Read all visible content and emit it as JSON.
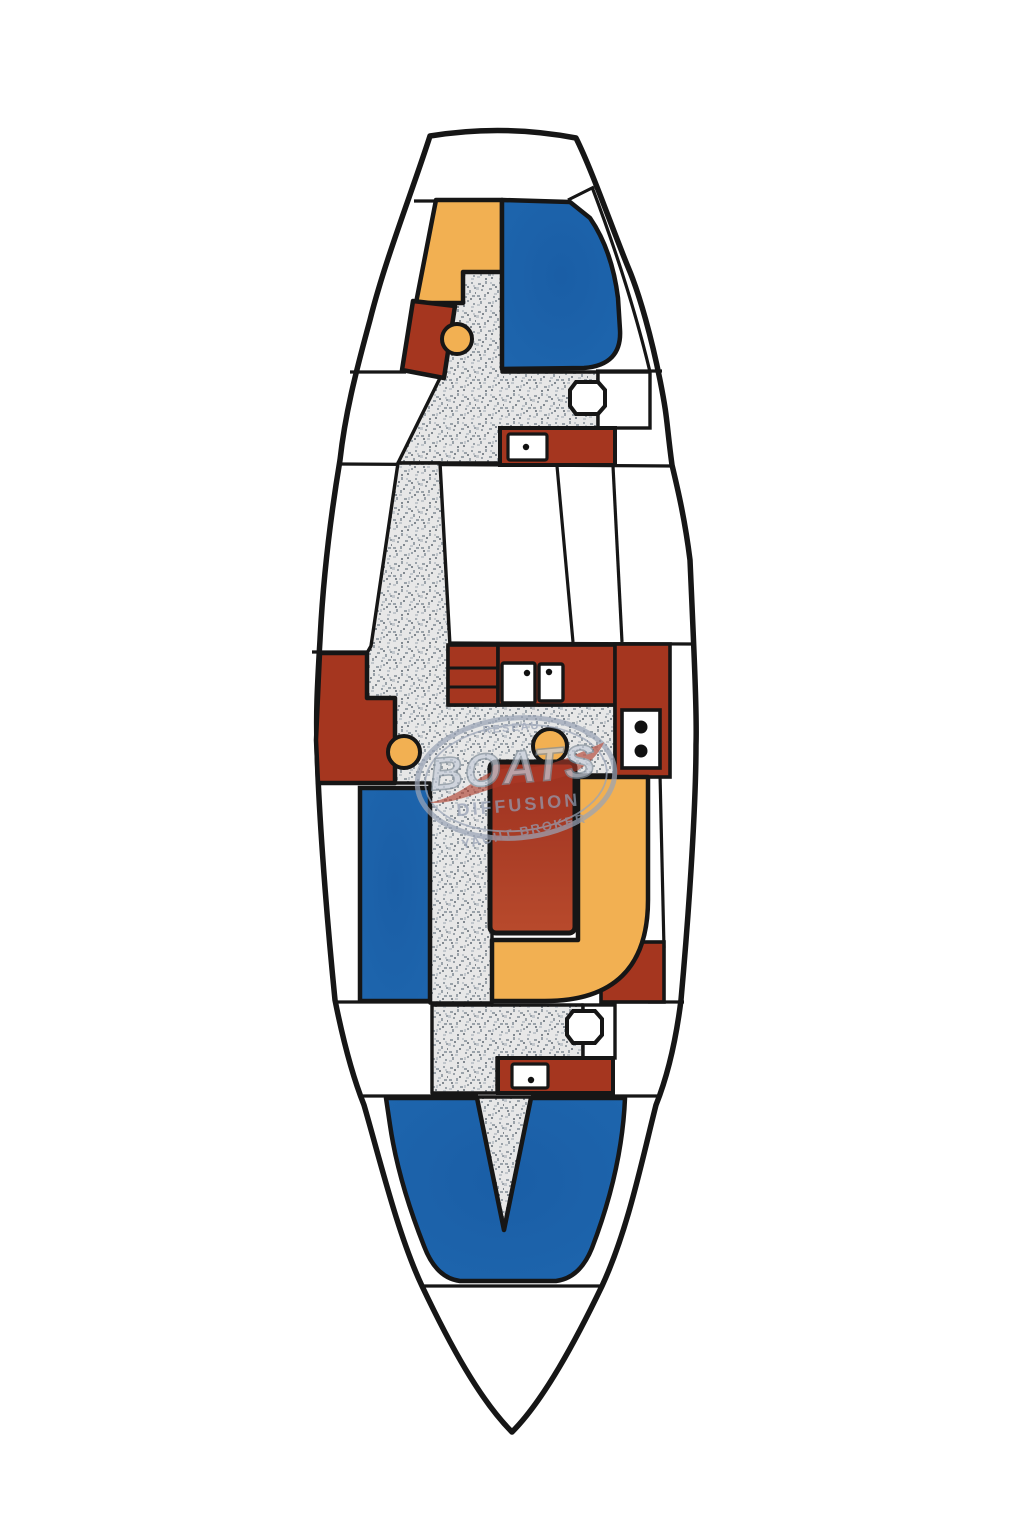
{
  "watermark": {
    "line1": "RESEAU",
    "line2": "BOATS",
    "line3": "DIFFUSION",
    "line4": "YACHT BROKER",
    "text_color": "#939db2",
    "big_fill": "#c6cdda",
    "big_stroke": "#84909c",
    "ring_color": "#9aa4b6",
    "swoosh_color": "#ad3a28"
  },
  "palette": {
    "hull_fill": "#ffffff",
    "outline": "#161616",
    "blue": "#1e66ae",
    "blue_deep": "#1a5ea6",
    "orange": "#f2b052",
    "red": "#a5361f",
    "red_dark": "#9d2f1d",
    "table_red_top": "#9d3120",
    "table_red_bottom": "#b84a2c",
    "floor_base": "#e7e7e7",
    "speck_dark": "#81888f",
    "speck_mid": "#9aa2a9",
    "speck_light": "#c2c7cc",
    "fixture_white": "#ffffff",
    "dot_black": "#111111"
  }
}
